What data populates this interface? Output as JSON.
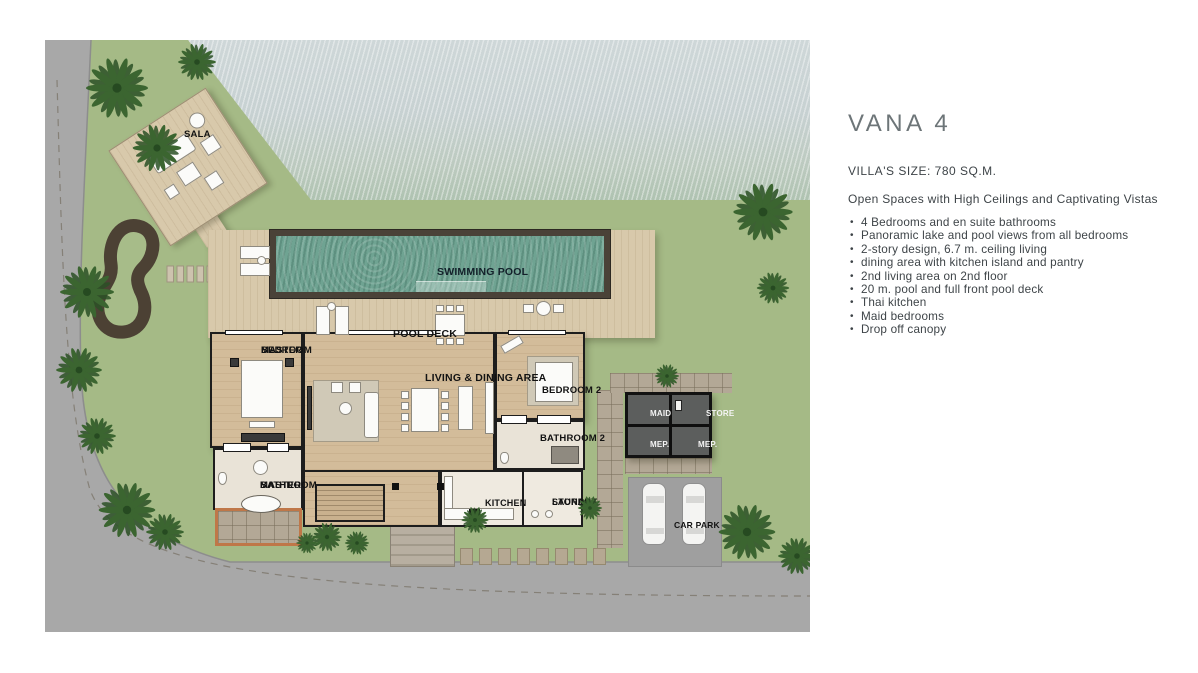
{
  "panel": {
    "title": "VANA 4",
    "size_line": "VILLA'S SIZE: 780 SQ.M.",
    "tagline": "Open Spaces with High Ceilings and Captivating Vistas",
    "features": [
      "4 Bedrooms and en suite bathrooms",
      "Panoramic lake and pool views from all bedrooms",
      "2-story design, 6.7 m. ceiling living",
      "dining area with kitchen island and pantry",
      "2nd living area on 2nd floor",
      "20 m. pool and full front pool deck",
      "Thai kitchen",
      "Maid bedrooms",
      "Drop off canopy"
    ]
  },
  "plan": {
    "labels": {
      "sala": "SALA",
      "swimming_pool": "SWIMMING POOL",
      "pool_deck": "POOL DECK",
      "master_bedroom_1": "MASTER",
      "master_bedroom_2": "BEDROOM",
      "living_dining": "LIVING & DINING AREA",
      "bedroom2": "BEDROOM 2",
      "bathroom2": "BATHROOM 2",
      "master_bathroom_1": "MASTER",
      "master_bathroom_2": "BATHROOM",
      "kitchen": "KITCHEN",
      "laundry_1": "LAUNDRY",
      "laundry_2": "STORAGE",
      "maid": "MAID",
      "store": "STORE",
      "mep_left": "MEP.",
      "mep_right": "MEP.",
      "car_park": "CAR PARK"
    },
    "colors": {
      "grass": "#a5ba86",
      "deck": "#d8c9ab",
      "floor": "#d3bc9a",
      "pool": "#6fa392",
      "wall": "#1d1d1d",
      "service": "#5c5e5d",
      "terracotta": "#bf7748",
      "road": "#a8a8a8"
    }
  }
}
